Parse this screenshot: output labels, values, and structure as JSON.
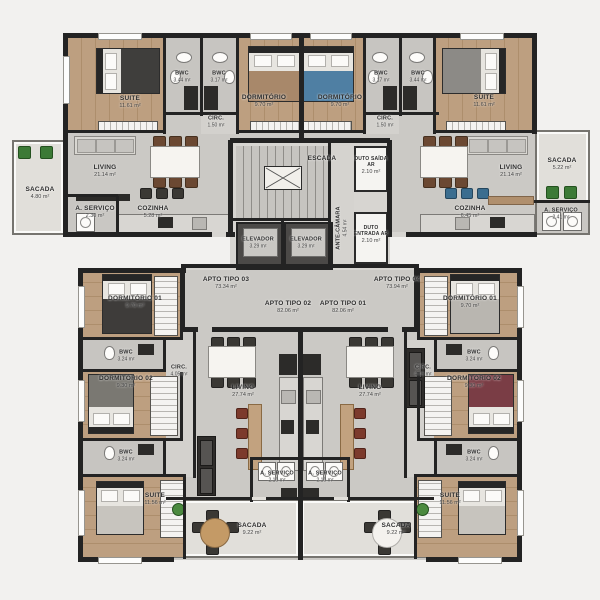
{
  "hall": {
    "tipo03": {
      "name": "APTO TIPO 03",
      "area": "73.34 m²"
    },
    "tipo04": {
      "name": "APTO TIPO 04",
      "area": "73.94 m²"
    },
    "tipo02": {
      "name": "APTO TIPO 02",
      "area": "82.06 m²"
    },
    "tipo01": {
      "name": "APTO TIPO 01",
      "area": "82.06 m²"
    }
  },
  "core": {
    "escada": {
      "name": "ESCADA"
    },
    "duto_saida": {
      "name": "DUTO SAÍDA AR",
      "area": "2.10 m²"
    },
    "ante_camara": {
      "name": "ANTE-CÂMARA",
      "area": "4.54 m²"
    },
    "duto_entrada": {
      "name": "DUTO ENTRADA AR",
      "area": "2.10 m²"
    },
    "elevador1": {
      "name": "ELEVADOR",
      "area": "3.29 m²"
    },
    "elevador2": {
      "name": "ELEVADOR",
      "area": "3.29 m²"
    }
  },
  "apartments": {
    "top_left": {
      "suite": {
        "name": "SUITE",
        "area": "11.61 m²"
      },
      "bwc1": {
        "name": "BWC",
        "area": "3.44 m²"
      },
      "bwc2": {
        "name": "BWC",
        "area": "3.17 m²"
      },
      "dormitorio": {
        "name": "DORMITÓRIO",
        "area": "9.70 m²"
      },
      "circ": {
        "name": "CIRC.",
        "area": "1.50 m²"
      },
      "living": {
        "name": "LIVING",
        "area": "21.14 m²"
      },
      "sacada": {
        "name": "SACADA",
        "area": "4.80 m²"
      },
      "servico": {
        "name": "A. SERVIÇO",
        "area": "2.30 m²"
      },
      "cozinha": {
        "name": "COZINHA",
        "area": "5.28 m²"
      }
    },
    "top_right": {
      "dormitorio": {
        "name": "DORMITÓRIO",
        "area": "9.70 m²"
      },
      "bwc1": {
        "name": "BWC",
        "area": "3.17 m²"
      },
      "bwc2": {
        "name": "BWC",
        "area": "3.44 m²"
      },
      "suite": {
        "name": "SUÍTE",
        "area": "11.61 m²"
      },
      "circ": {
        "name": "CIRC.",
        "area": "1.50 m²"
      },
      "living": {
        "name": "LIVING",
        "area": "21.14 m²"
      },
      "sacada": {
        "name": "SACADA",
        "area": "5.22 m²"
      },
      "cozinha": {
        "name": "COZINHA",
        "area": "6.45 m²"
      },
      "servico": {
        "name": "A. SERVIÇO",
        "area": "2.41 m²"
      }
    },
    "bottom_left": {
      "dormitorio1": {
        "name": "DORMITÓRIO 01",
        "area": "9.70 m²"
      },
      "bwc1": {
        "name": "BWC",
        "area": "3.24 m²"
      },
      "dormitorio2": {
        "name": "DORMITÓRIO 02",
        "area": "9.30 m²"
      },
      "circ": {
        "name": "CIRC.",
        "area": "4.05 m²"
      },
      "bwc2": {
        "name": "BWC",
        "area": "3.24 m²"
      },
      "suite": {
        "name": "SUITE",
        "area": "11.56 m²"
      },
      "living": {
        "name": "LIVING",
        "area": "27.74 m²"
      },
      "servico": {
        "name": "A. SERVIÇO",
        "area": "2.10 m²"
      },
      "sacada": {
        "name": "SACADA",
        "area": "9.22 m²"
      }
    },
    "bottom_right": {
      "dormitorio1": {
        "name": "DORMITÓRIO 01",
        "area": "9.70 m²"
      },
      "bwc1": {
        "name": "BWC",
        "area": "3.24 m²"
      },
      "dormitorio2": {
        "name": "DORMITÓRIO 02",
        "area": "9.30 m²"
      },
      "circ": {
        "name": "CIRC.",
        "area": "4.05 m²"
      },
      "bwc2": {
        "name": "BWC",
        "area": "3.24 m²"
      },
      "suite": {
        "name": "SUITE",
        "area": "11.56 m²"
      },
      "living": {
        "name": "LIVING",
        "area": "27.74 m²"
      },
      "servico": {
        "name": "A. SERVIÇO",
        "area": "2.10 m²"
      },
      "sacada": {
        "name": "SACADA",
        "area": "9.22 m²"
      }
    }
  }
}
